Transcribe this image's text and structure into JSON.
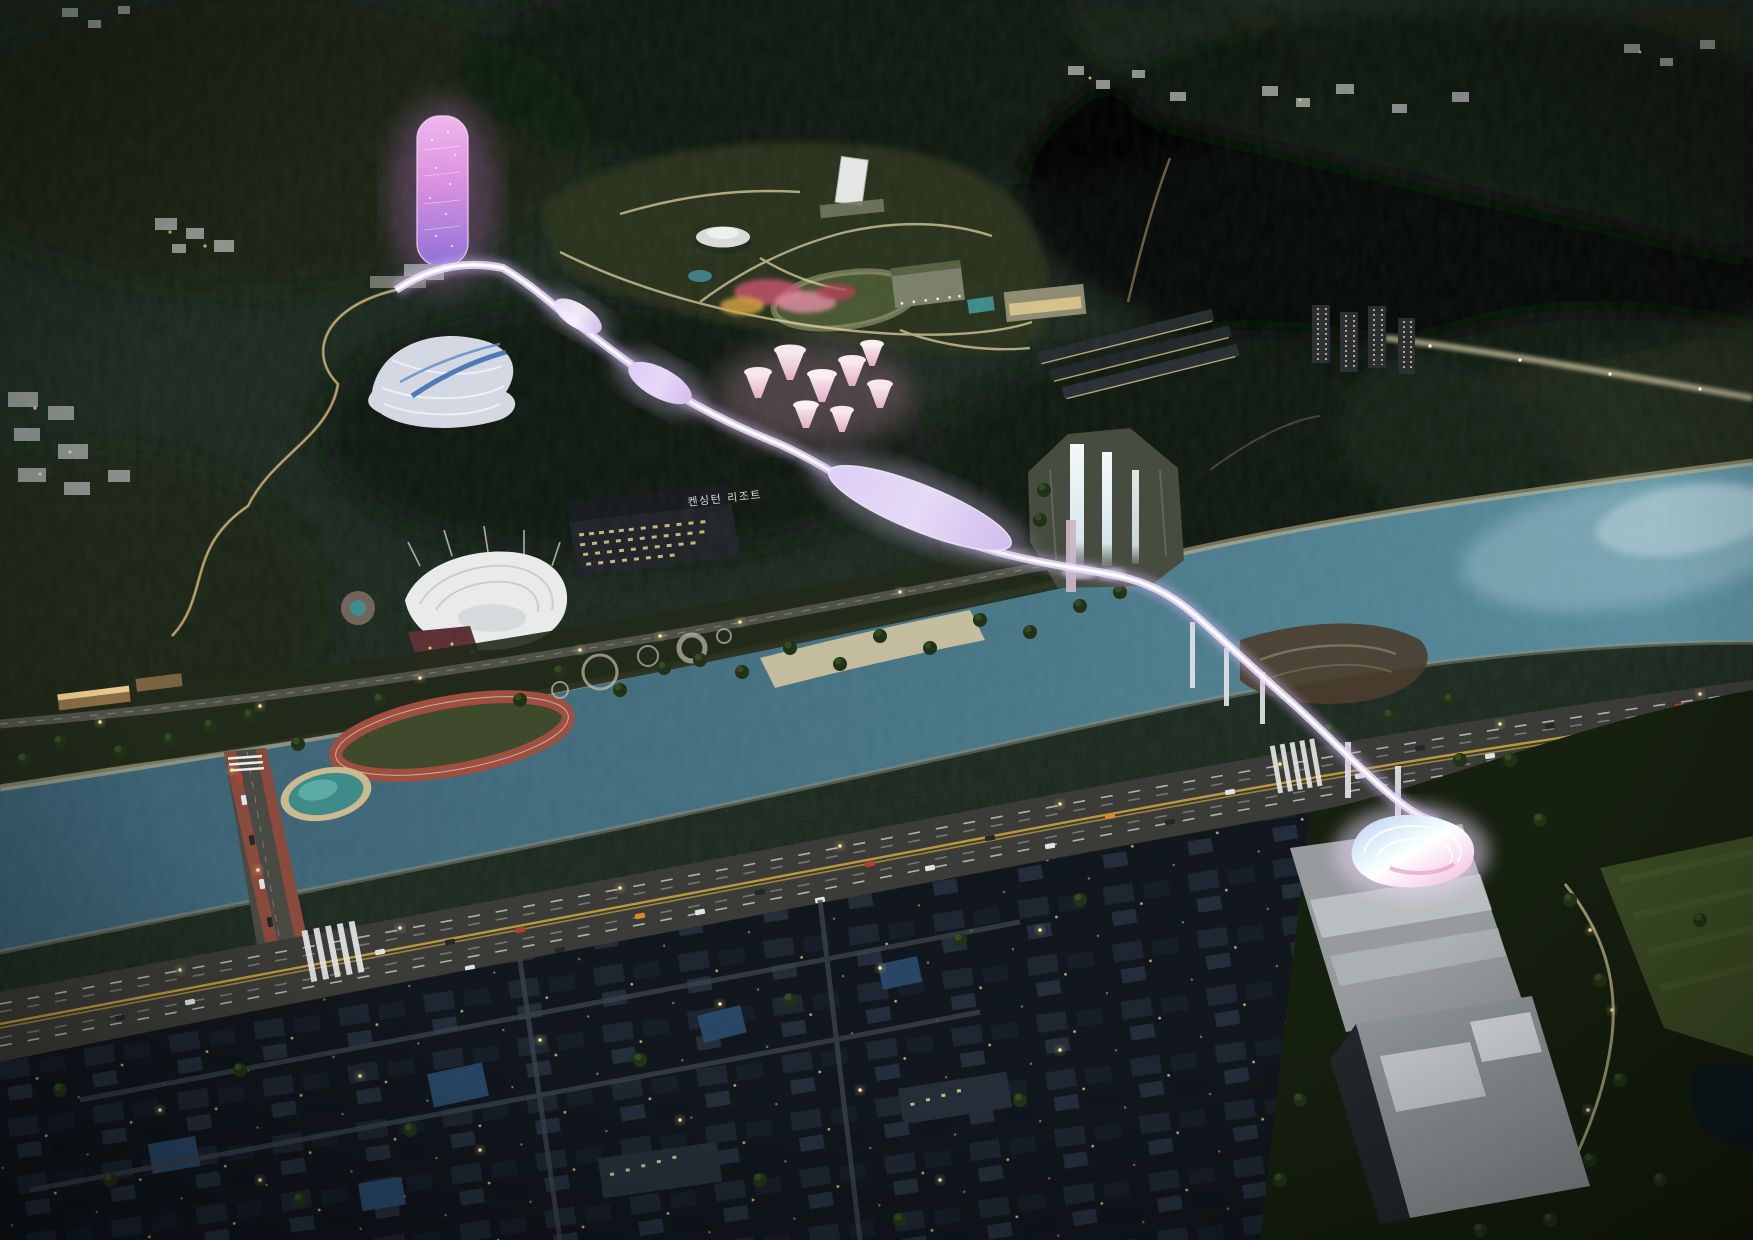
{
  "scene": {
    "kind": "aerial-night-architectural-render",
    "labels": {
      "resort_sign": "켄싱턴 리조트"
    },
    "palette": {
      "forest_base": "#0c130e",
      "forest_light": "#1c2a1b",
      "park_plateau": "#2a331f",
      "river": "#44707f",
      "river_light": "#7fa9b6",
      "walkway_glow": "#cfb3f0",
      "walkway_core": "#ffffff",
      "tower_pink": "#ee9ce2",
      "tower_purple": "#8f6fd8",
      "canopy_pink": "#f0c6d6",
      "amphitheater_white": "#e9ebea",
      "track_red": "#9e4f3f",
      "lagoon_teal": "#3f8b8a",
      "highway_asphalt": "#3b3c37",
      "lane_yellow": "#c9a23f",
      "warm_light": "#f2d795",
      "city_roof": "#1c2530",
      "plaza_concrete": "#979b9d",
      "waterfall_white": "#eef4f6",
      "bridge_red": "#8a4a3c"
    }
  }
}
